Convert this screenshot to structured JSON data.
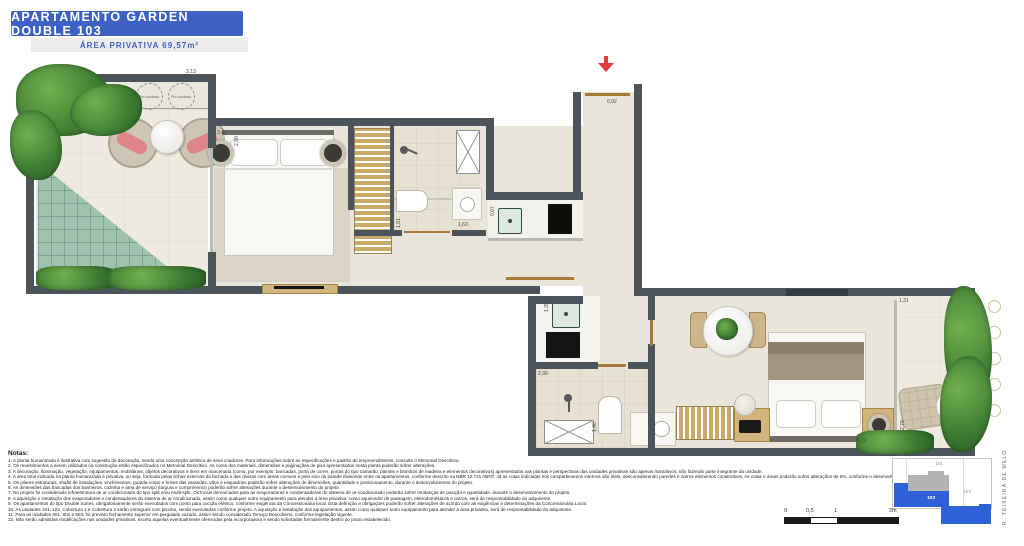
{
  "header": {
    "title": "APARTAMENTO GARDEN DOUBLE 103",
    "subtitle": "ÁREA PRIVATIVA 69,57m²"
  },
  "plan": {
    "condenser_label": "Pto condens.",
    "dims": [
      "3,13",
      "3,41",
      "2,90",
      "0,92",
      "1,91",
      "1,63",
      "0,67",
      "1,39",
      "2,30",
      "1,40",
      "4,22",
      "1,31",
      "2,79"
    ]
  },
  "notes": {
    "heading": "Notas:",
    "items": [
      "1. A planta humanizada é ilustrativa com sugestão de decoração, sendo uma concepção artística de seus criadores. Para informações sobre as especificações e padrão do empreendimento, consulte o Memorial Descritivo.",
      "2. Os revestimentos a serem utilizados na construção estão especificados no Memorial Descritivo. As cores dos materiais, dimensões e paginações de piso apresentados nesta planta poderão sofrer alterações.",
      "3. A decoração, iluminação, vegetação, equipamentos, mobiliários, objetos decorativos e itens em marcenaria (como, por exemplo: bancadas, porta de correr, portas do tipo camarão, painéis e biombos de madeira e elementos decorativos) apresentados nas plantas e perspectivas das unidades privativas são apenas ilustrativos, não fazendo parte integrante da unidade.",
      "4. A área total indicada na planta humanizada é privativa, ou seja, formada pelas linhas externas da fachada e das divisas com áreas comuns e pelo eixo da parede divisórias entre os apartamentos, conforme descrito na NBR 12.721 ABNT. Já as cotas indicadas nos compartimentos internos são úteis, desconsiderando paredes e outros elementos construtivos. As cotas e áreas poderão sofrer alterações de 5%, conforme o desenvolvimento do projeto.",
      "5. Os pilares estruturais, shafts de instalações, enchimentos, guarda-corpo e brises das varandas, vãos e esquadrias poderão sofrer alterações de dimensões, quantidade e posicionamento, durante o desenvolvimento do projeto.",
      "6. As dimensões das bancadas dos banheiros, cozinha e área de serviço (largura e comprimento) poderão sofrer alterações durante o desenvolvimento do projeto.",
      "7. No projeto foi considerado infraestrutura de ar condicionado do tipo split e/ou multi-split. Os locais demarcados para as evaporadoras e condensadoras do sistema de ar-condicionado poderão sofrer mudanças de posição e quantidade, durante o desenvolvimento do projeto.",
      "8. A aquisição e instalação dos evaporadores e condensadores do sistema de ar condicionado, assim como qualquer outro equipamento para atender a área privativa, como aquecedor de passagem, eletrodomésticos e outros, será de responsabilidade do adquirente.",
      "9. Os apartamentos do tipo Double Suítes, obrigatoriamente serão executados com ponto para cocção elétrico, conforme exigência da Concessionária local. Esta definição e obrigações poderão sofrer alterações de acordo com as exigências e determinações da Concessionária Local.",
      "10. As unidades 101, 103, Cobertura 1 e Cobertura 2 serão entregues com piscina, sendo executadas conforme projeto. A aquisição e instalação dos equipamentos, assim como qualquer outro equipamento para atender a área privativa, será de responsabilidade do adquirente.",
      "11. Para as unidades 801, 802 e 803, foi previsto fechamento superior em pergolado vazado, assim sendo considerado Terraço Descoberto, conforme legislação vigente.",
      "12. Não serão admitidas modificações nas unidades privativas, exceto aquelas eventualmente oferecidas pela incorporadora e sendo solicitadas formalmente dentro do prazo estabelecido."
    ]
  },
  "scale": {
    "labels": [
      "0",
      "0,5",
      "1",
      "2m"
    ]
  },
  "keyplan": {
    "units": [
      {
        "label": "101"
      },
      {
        "label": "102"
      },
      {
        "label": "103"
      }
    ],
    "street": "R. TEIXEIRA DE MELO",
    "highlight_color": "#2f62d8"
  }
}
